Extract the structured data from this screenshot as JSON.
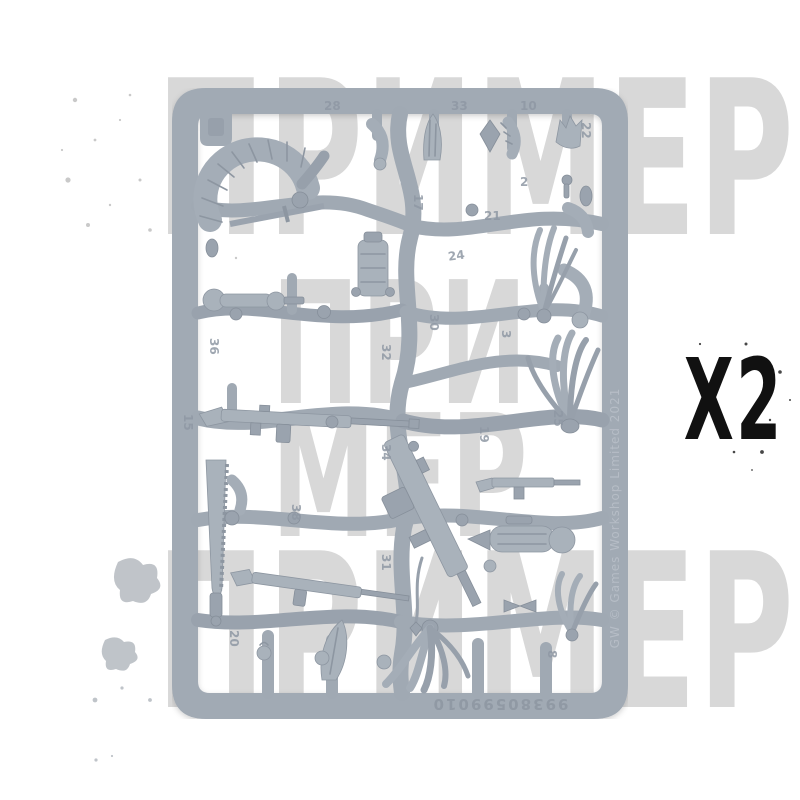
{
  "page": {
    "background_color": "#ffffff"
  },
  "quantity": {
    "label": "X2",
    "color": "#111111"
  },
  "watermark": {
    "word": "ПРИМЕР",
    "middle_top": "ПРИ",
    "middle_bottom": "МЕР",
    "color": "#d8d8d8"
  },
  "sprue": {
    "base_color": "#a1aab4",
    "light_color": "#b7bec7",
    "dark_color": "#8b949f",
    "copyright": "GW © Games Workshop Limited 2021",
    "product_code": "99380599010",
    "part_numbers": [
      "28",
      "33",
      "10",
      "22",
      "17",
      "21",
      "24",
      "32",
      "30",
      "3",
      "34",
      "19",
      "25",
      "31",
      "20",
      "38",
      "36",
      "15",
      "8",
      "2"
    ]
  }
}
